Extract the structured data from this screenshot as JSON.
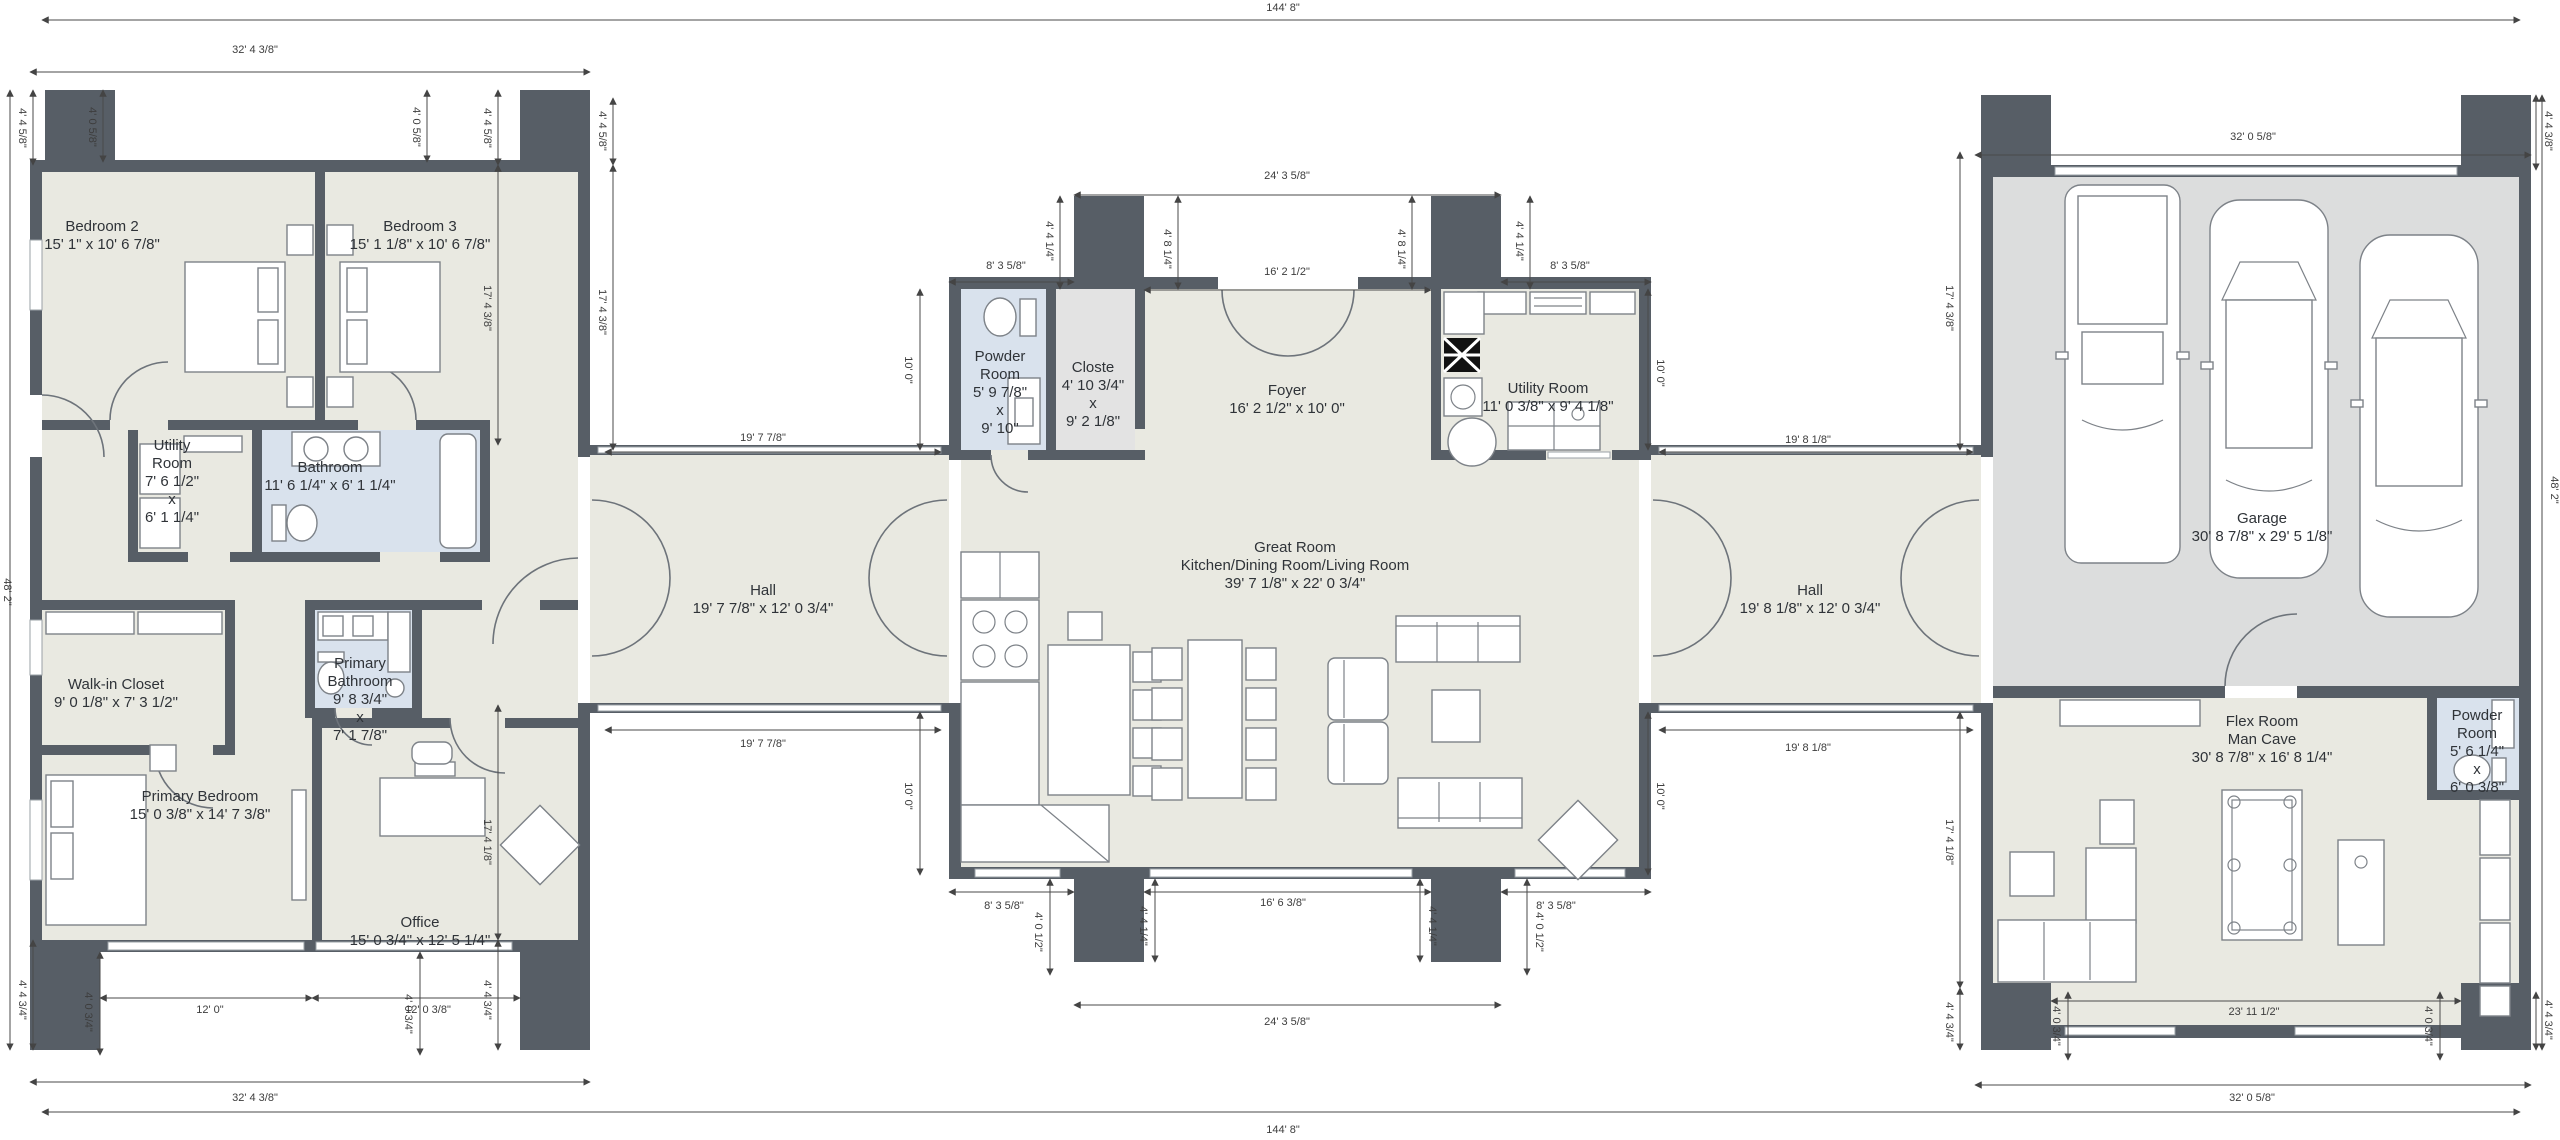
{
  "colors": {
    "wall": "#575e66",
    "floor": "#e9e9e1",
    "garage_floor": "#dcdddd",
    "wet_room": "#d9e2ed",
    "closet": "#e3e3e3",
    "background": "#ffffff",
    "dimension_text": "#3d3d3d",
    "room_text": "#2f3338"
  },
  "rooms": [
    {
      "id": "bedroom-2",
      "lines": [
        "Bedroom 2",
        "15' 1\" x 10' 6 7/8\""
      ],
      "x": 102,
      "y": 236
    },
    {
      "id": "bedroom-3",
      "lines": [
        "Bedroom 3",
        "15' 1 1/8\" x 10' 6 7/8\""
      ],
      "x": 420,
      "y": 236
    },
    {
      "id": "utility-room-left",
      "lines": [
        "Utility",
        "Room",
        "7' 6 1/2\"",
        "x",
        "6' 1 1/4\""
      ],
      "x": 172,
      "y": 482
    },
    {
      "id": "bathroom",
      "lines": [
        "Bathroom",
        "11' 6 1/4\" x 6' 1 1/4\""
      ],
      "x": 330,
      "y": 477
    },
    {
      "id": "walk-in-closet",
      "lines": [
        "Walk-in Closet",
        "9' 0 1/8\" x 7' 3 1/2\""
      ],
      "x": 116,
      "y": 694
    },
    {
      "id": "primary-bathroom",
      "lines": [
        "Primary",
        "Bathroom",
        "9' 8 3/4\"",
        "x",
        "7' 1 7/8\""
      ],
      "x": 360,
      "y": 700
    },
    {
      "id": "primary-bedroom",
      "lines": [
        "Primary Bedroom",
        "15' 0 3/8\" x 14' 7 3/8\""
      ],
      "x": 200,
      "y": 806
    },
    {
      "id": "office",
      "lines": [
        "Office",
        "15' 0 3/4\" x 12' 5 1/4\""
      ],
      "x": 420,
      "y": 932
    },
    {
      "id": "hall-left",
      "lines": [
        "Hall",
        "19' 7 7/8\" x 12' 0 3/4\""
      ],
      "x": 763,
      "y": 600
    },
    {
      "id": "powder-room-center",
      "lines": [
        "Powder",
        "Room",
        "5' 9 7/8\"",
        "x",
        "9' 10\""
      ],
      "x": 1000,
      "y": 393
    },
    {
      "id": "closte",
      "lines": [
        "Closte",
        "4' 10 3/4\"",
        "x",
        "9' 2 1/8\""
      ],
      "x": 1093,
      "y": 395
    },
    {
      "id": "foyer",
      "lines": [
        "Foyer",
        "16' 2 1/2\" x 10' 0\""
      ],
      "x": 1287,
      "y": 400
    },
    {
      "id": "utility-room-center",
      "lines": [
        "Utility Room",
        "11' 0 3/8\" x 9' 4 1/8\""
      ],
      "x": 1548,
      "y": 398
    },
    {
      "id": "great-room",
      "lines": [
        "Great Room",
        "Kitchen/Dining Room/Living Room",
        "39' 7 1/8\" x 22' 0 3/4\""
      ],
      "x": 1295,
      "y": 566
    },
    {
      "id": "hall-right",
      "lines": [
        "Hall",
        "19' 8 1/8\" x 12' 0 3/4\""
      ],
      "x": 1810,
      "y": 600
    },
    {
      "id": "garage",
      "lines": [
        "Garage",
        "30' 8 7/8\" x 29' 5 1/8\""
      ],
      "x": 2262,
      "y": 528
    },
    {
      "id": "flex-room",
      "lines": [
        "Flex Room",
        "Man Cave",
        "30' 8 7/8\" x 16' 8 1/4\""
      ],
      "x": 2262,
      "y": 740
    },
    {
      "id": "powder-room-right",
      "lines": [
        "Powder",
        "Room",
        "5' 6 1/4\"",
        "x",
        "6' 0 3/8\""
      ],
      "x": 2477,
      "y": 752
    }
  ],
  "dimensions": [
    {
      "text": "144' 8\"",
      "x": 1283,
      "y": 8
    },
    {
      "text": "32' 4 3/8\"",
      "x": 255,
      "y": 50
    },
    {
      "text": "32' 0 5/8\"",
      "x": 2253,
      "y": 137
    },
    {
      "text": "24' 3 5/8\"",
      "x": 1287,
      "y": 176
    },
    {
      "text": "8' 3 5/8\"",
      "x": 1006,
      "y": 266
    },
    {
      "text": "16' 2 1/2\"",
      "x": 1287,
      "y": 272
    },
    {
      "text": "8' 3 5/8\"",
      "x": 1570,
      "y": 266
    },
    {
      "text": "4' 4 5/8\"",
      "x": 22,
      "y": 128,
      "rot": 90
    },
    {
      "text": "4' 0 5/8\"",
      "x": 92,
      "y": 127,
      "rot": 90
    },
    {
      "text": "4' 0 5/8\"",
      "x": 416,
      "y": 127,
      "rot": 90
    },
    {
      "text": "4' 4 5/8\"",
      "x": 487,
      "y": 128,
      "rot": 90
    },
    {
      "text": "4' 4 5/8\"",
      "x": 602,
      "y": 131,
      "rot": 90
    },
    {
      "text": "4' 4 1/4\"",
      "x": 1049,
      "y": 241,
      "rot": 90
    },
    {
      "text": "4' 8 1/4\"",
      "x": 1167,
      "y": 249,
      "rot": 90
    },
    {
      "text": "4' 8 1/4\"",
      "x": 1401,
      "y": 249,
      "rot": 90
    },
    {
      "text": "4' 4 1/4\"",
      "x": 1519,
      "y": 241,
      "rot": 90
    },
    {
      "text": "4' 4 3/8\"",
      "x": 2548,
      "y": 131,
      "rot": 90
    },
    {
      "text": "17' 4 3/8\"",
      "x": 487,
      "y": 308,
      "rot": 90
    },
    {
      "text": "17' 4 3/8\"",
      "x": 602,
      "y": 312,
      "rot": 90
    },
    {
      "text": "17' 4 3/8\"",
      "x": 1949,
      "y": 308,
      "rot": 90
    },
    {
      "text": "10' 0\"",
      "x": 908,
      "y": 370,
      "rot": 90
    },
    {
      "text": "10' 0\"",
      "x": 1660,
      "y": 373,
      "rot": 90
    },
    {
      "text": "19' 7 7/8\"",
      "x": 763,
      "y": 438
    },
    {
      "text": "19' 8 1/8\"",
      "x": 1808,
      "y": 440
    },
    {
      "text": "48' 2\"",
      "x": 7,
      "y": 592,
      "rot": 90
    },
    {
      "text": "48' 2\"",
      "x": 2554,
      "y": 490,
      "rot": 90
    },
    {
      "text": "19' 7 7/8\"",
      "x": 763,
      "y": 744
    },
    {
      "text": "19' 8 1/8\"",
      "x": 1808,
      "y": 748
    },
    {
      "text": "10' 0\"",
      "x": 908,
      "y": 796,
      "rot": 90
    },
    {
      "text": "10' 0\"",
      "x": 1660,
      "y": 796,
      "rot": 90
    },
    {
      "text": "17' 4 1/8\"",
      "x": 487,
      "y": 842,
      "rot": 90
    },
    {
      "text": "17' 4 1/8\"",
      "x": 1949,
      "y": 842,
      "rot": 90
    },
    {
      "text": "8' 3 5/8\"",
      "x": 1004,
      "y": 906
    },
    {
      "text": "16' 6 3/8\"",
      "x": 1283,
      "y": 903
    },
    {
      "text": "8' 3 5/8\"",
      "x": 1556,
      "y": 906
    },
    {
      "text": "4' 0 1/2\"",
      "x": 1038,
      "y": 932,
      "rot": 90
    },
    {
      "text": "4' 4 1/4\"",
      "x": 1143,
      "y": 926,
      "rot": 90
    },
    {
      "text": "4' 4 1/4\"",
      "x": 1432,
      "y": 926,
      "rot": 90
    },
    {
      "text": "4' 0 1/2\"",
      "x": 1539,
      "y": 932,
      "rot": 90
    },
    {
      "text": "4' 0 3/4\"",
      "x": 88,
      "y": 1012,
      "rot": 90
    },
    {
      "text": "4' 0 3/4\"",
      "x": 408,
      "y": 1014,
      "rot": 90
    },
    {
      "text": "12' 0\"",
      "x": 210,
      "y": 1010
    },
    {
      "text": "12' 0 3/8\"",
      "x": 428,
      "y": 1010
    },
    {
      "text": "4' 4 3/4\"",
      "x": 22,
      "y": 1000,
      "rot": 90
    },
    {
      "text": "4' 4 3/4\"",
      "x": 487,
      "y": 1000,
      "rot": 90
    },
    {
      "text": "4' 4 3/4\"",
      "x": 1949,
      "y": 1022,
      "rot": 90
    },
    {
      "text": "4' 0 3/4\"",
      "x": 2056,
      "y": 1026,
      "rot": 90
    },
    {
      "text": "4' 0 3/4\"",
      "x": 2428,
      "y": 1026,
      "rot": 90
    },
    {
      "text": "4' 4 3/4\"",
      "x": 2548,
      "y": 1020,
      "rot": 90
    },
    {
      "text": "23' 11 1/2\"",
      "x": 2254,
      "y": 1012
    },
    {
      "text": "24' 3 5/8\"",
      "x": 1287,
      "y": 1022
    },
    {
      "text": "32' 4 3/8\"",
      "x": 255,
      "y": 1098
    },
    {
      "text": "32' 0 5/8\"",
      "x": 2252,
      "y": 1098
    },
    {
      "text": "144' 8\"",
      "x": 1283,
      "y": 1130
    }
  ]
}
